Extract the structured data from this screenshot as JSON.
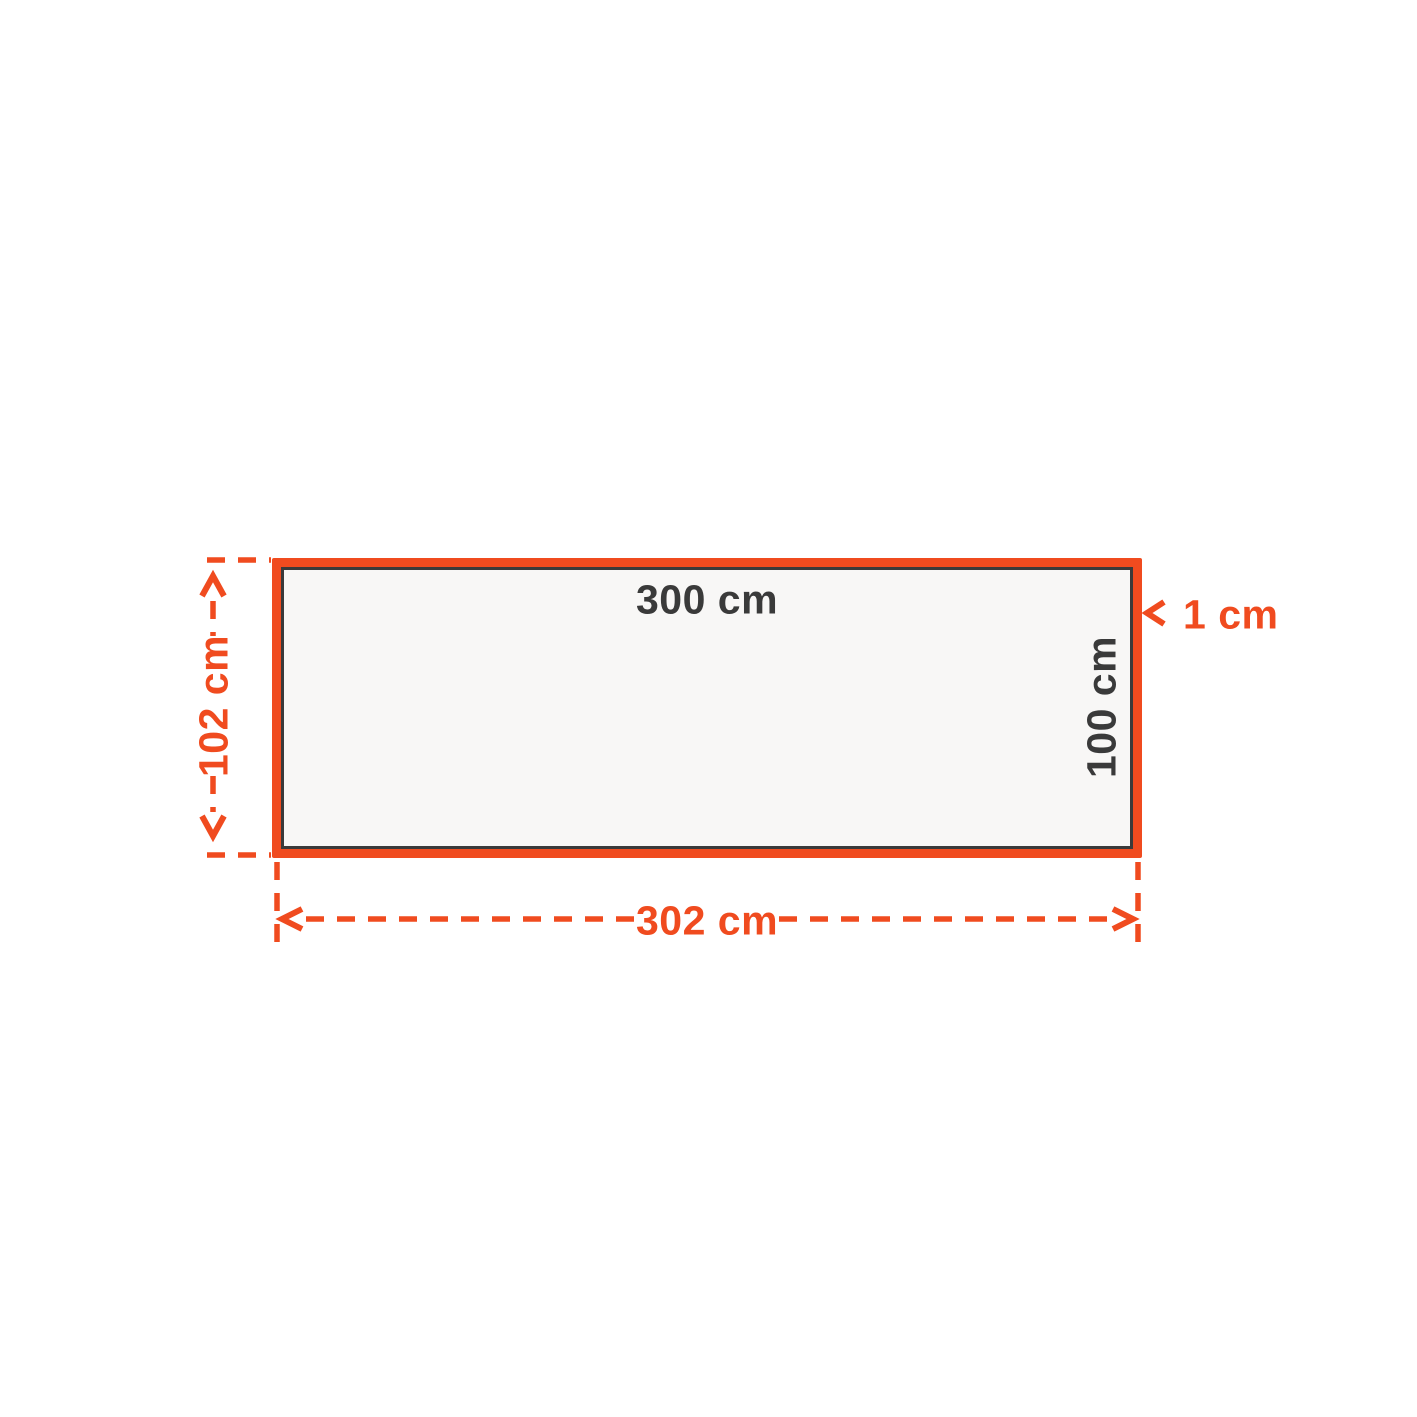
{
  "colors": {
    "accent_orange": "#F04B1F",
    "dark_gray": "#3A3A3A",
    "panel_fill": "#F8F7F6",
    "background": "#FFFFFF"
  },
  "panel": {
    "inner_width_label": "300 cm",
    "inner_height_label": "100 cm"
  },
  "dimensions": {
    "outer_height_label": "102 cm",
    "outer_width_label": "302 cm",
    "border_thickness_label": "1 cm"
  }
}
